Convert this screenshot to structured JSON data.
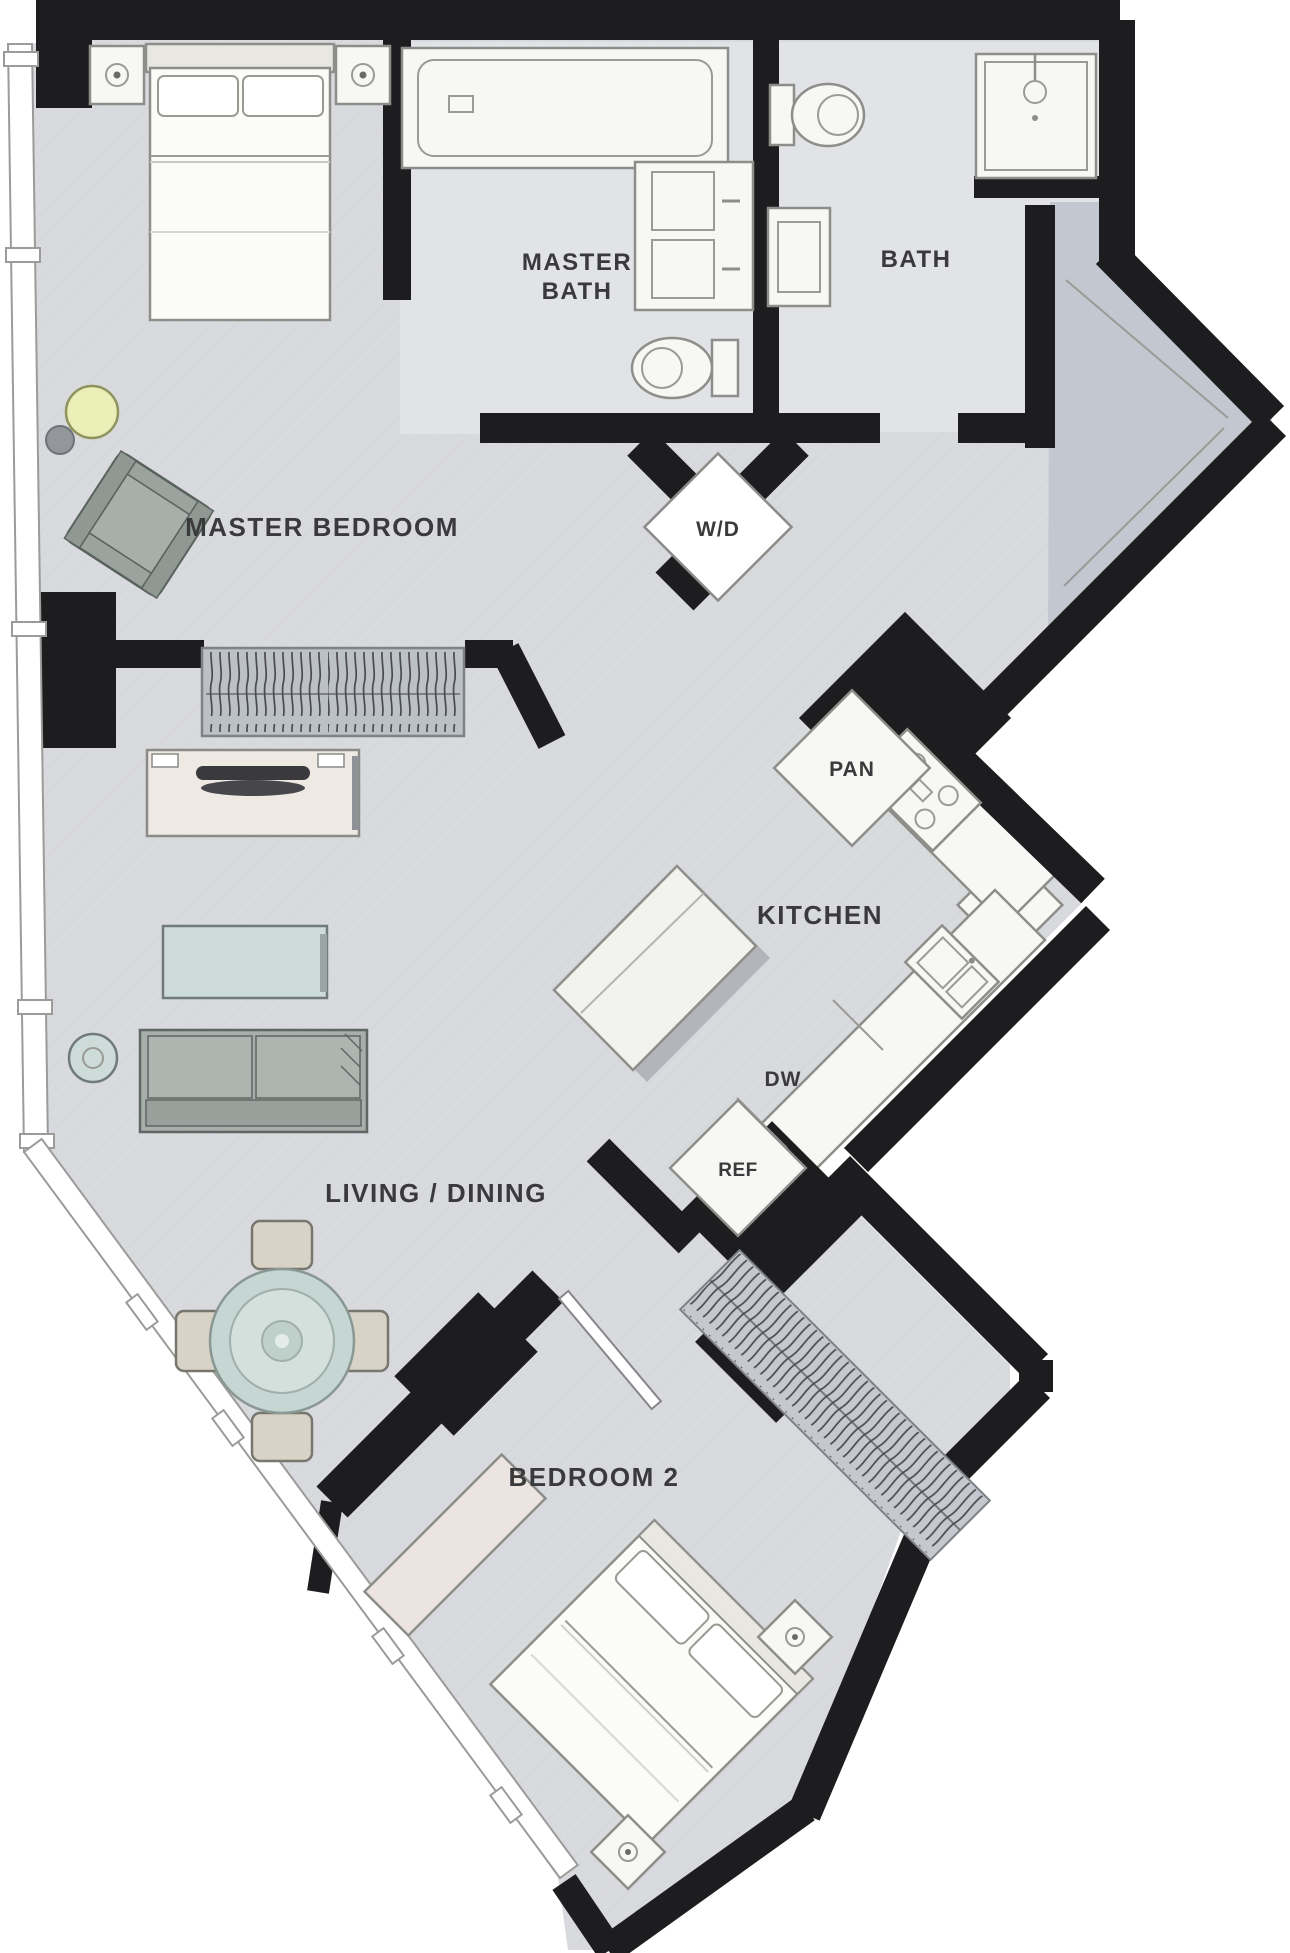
{
  "page": {
    "title": "Two bedroom apartment floor plan"
  },
  "colors": {
    "wall": "#1d1d1f",
    "floor": "#d9dade",
    "floor_bath": "#e2e3e6",
    "floor_closet": "#c3c7cf",
    "fixture": "#f7f7f4",
    "accent_table": "#cddcd8",
    "accent_lamp": "#e9efb6",
    "sofa": "#a7aeab",
    "dresser": "#ece4e1",
    "text": "#3a3a3c"
  },
  "labels": {
    "master_bedroom": "MASTER BEDROOM",
    "master_bath1": "MASTER",
    "master_bath2": "BATH",
    "bath": "BATH",
    "wd": "W/D",
    "pan": "PAN",
    "kitchen": "KITCHEN",
    "dw": "DW",
    "ref": "REF",
    "living_dining": "LIVING / DINING",
    "bedroom2": "BEDROOM 2"
  }
}
